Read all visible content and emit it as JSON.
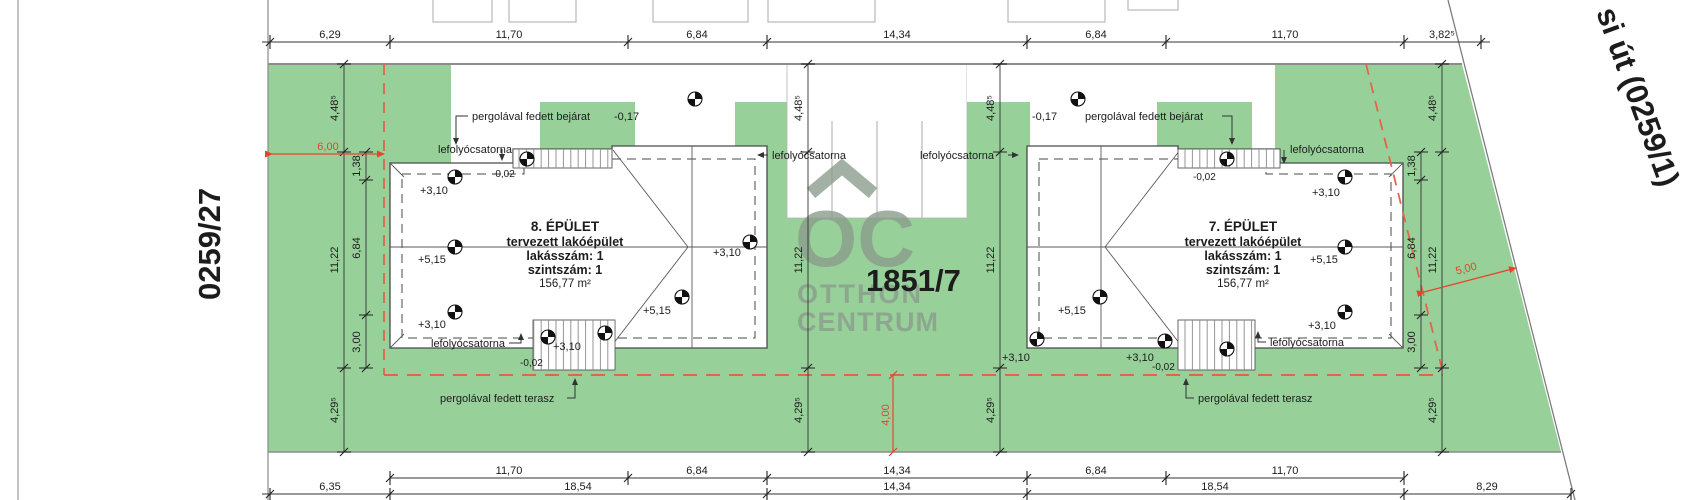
{
  "parcels": {
    "neighbor_left": "0259/27",
    "road_right": "si út (0259/1)",
    "site": "1851/7"
  },
  "watermark": {
    "monogram": "OC",
    "line1": "OTTHON",
    "line2": "CENTRUM"
  },
  "buildings": [
    {
      "name": "8. ÉPÜLET",
      "type": "tervezett lakóépület",
      "units": "lakásszám: 1",
      "floors": "szintszám: 1",
      "area": "156,77 m²"
    },
    {
      "name": "7. ÉPÜLET",
      "type": "tervezett lakóépület",
      "units": "lakásszám: 1",
      "floors": "szintszám: 1",
      "area": "156,77 m²"
    }
  ],
  "labels": {
    "downspout": "lefolyócsatorna",
    "pergola_entrance": "pergolával fedett bejárat",
    "pergola_terrace": "pergolával fedett terasz"
  },
  "levels": {
    "eave": "+3,10",
    "ridge": "+5,15",
    "entrance": "-0,17",
    "threshold": "-0,02"
  },
  "dimensions": {
    "top": [
      "6,29",
      "11,70",
      "6,84",
      "14,34",
      "6,84",
      "11,70",
      "3,82⁵"
    ],
    "bottom_row1": [
      "11,70",
      "6,84",
      "14,34",
      "6,84",
      "11,70"
    ],
    "bottom_row2": [
      "6,35",
      "18,54",
      "14,34",
      "18,54",
      "8,29"
    ],
    "left_outer": [
      "4,48⁵",
      "11,22",
      "4,29⁵"
    ],
    "left_inner": [
      "1,38",
      "6,84",
      "3,00"
    ],
    "center_left": [
      "4,48⁵",
      "11,22",
      "4,29⁵"
    ],
    "center_right": [
      "4,48⁵",
      "11,22",
      "4,29⁵"
    ],
    "right_inner": [
      "1,38",
      "6,84",
      "3,00"
    ],
    "right_outer": [
      "4,48⁵",
      "11,22",
      "4,29⁵"
    ],
    "setback_left": "6,00",
    "setback_right": "5,00",
    "setback_bottom": "4,00"
  },
  "colors": {
    "grass": "#98d09a",
    "red_dim": "#e8432c",
    "orange_dash": "#e2654a",
    "watermark": "#8b9d8d"
  }
}
